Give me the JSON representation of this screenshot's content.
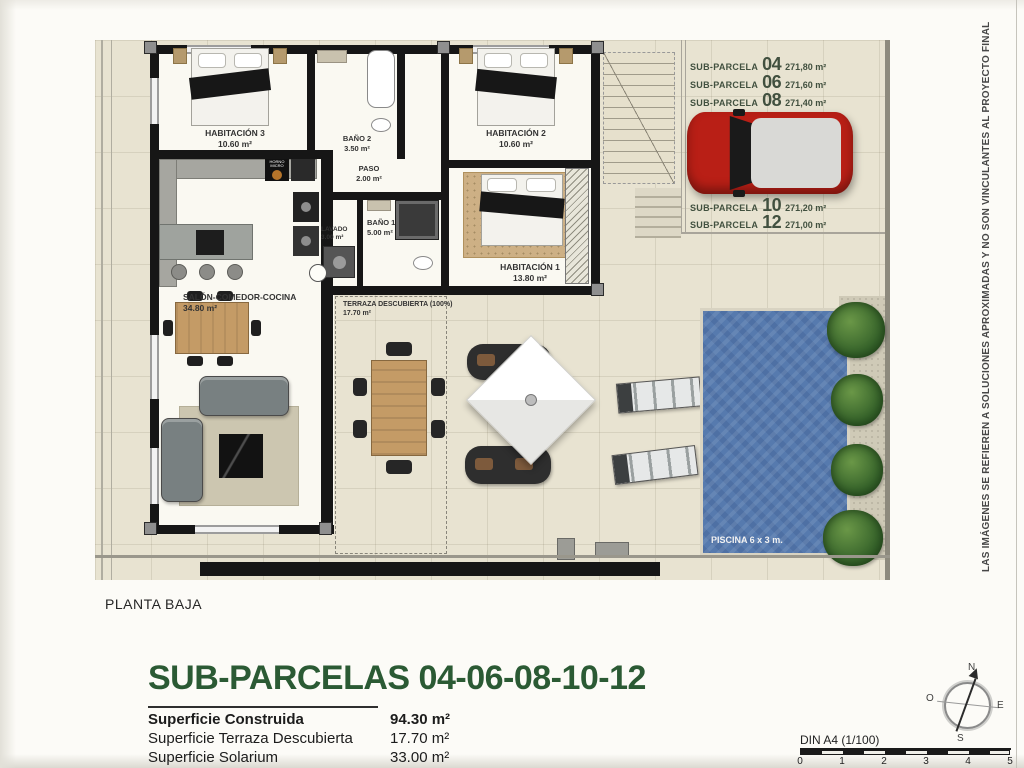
{
  "page": {
    "planta_label": "PLANTA BAJA",
    "title": "SUB-PARCELAS 04-06-08-10-12",
    "disclaimer": "LAS IMÁGENES SE REFIEREN A SOLUCIONES APROXIMADAS Y NO SON VINCULANTES AL PROYECTO FINAL"
  },
  "subparcelas": {
    "top": [
      {
        "label": "SUB-PARCELA",
        "number": "04",
        "area": "271,80 m²"
      },
      {
        "label": "SUB-PARCELA",
        "number": "06",
        "area": "271,60 m²"
      },
      {
        "label": "SUB-PARCELA",
        "number": "08",
        "area": "271,40 m²"
      }
    ],
    "bottom": [
      {
        "label": "SUB-PARCELA",
        "number": "10",
        "area": "271,20 m²"
      },
      {
        "label": "SUB-PARCELA",
        "number": "12",
        "area": "271,00 m²"
      }
    ]
  },
  "rooms": {
    "habitacion3": {
      "name": "HABITACIÓN 3",
      "area": "10.60 m²"
    },
    "bano2": {
      "name": "BAÑO 2",
      "area": "3.50 m²"
    },
    "habitacion2": {
      "name": "HABITACIÓN 2",
      "area": "10.60 m²"
    },
    "paso": {
      "name": "PASO",
      "area": "2.00 m²"
    },
    "lavado": {
      "name": "LAVADO",
      "area": "3.00 m²"
    },
    "bano1": {
      "name": "BAÑO 1",
      "area": "5.00 m²"
    },
    "habitacion1": {
      "name": "HABITACIÓN 1",
      "area": "13.80 m²"
    },
    "salon": {
      "name": "SALÓN-COMEDOR-COCINA",
      "area": "34.80 m²"
    },
    "terraza": {
      "name": "TERRAZA DESCUBIERTA (100%)",
      "area": "17.70 m²"
    }
  },
  "kitchen": {
    "appliance_label": "HORNO MICRO"
  },
  "piscina": {
    "label": "PISCINA 6 x 3 m."
  },
  "surfaces": [
    {
      "label": "Superficie Construida",
      "value": "94.30 m²"
    },
    {
      "label": "Superficie Terraza Descubierta",
      "value": "17.70 m²"
    },
    {
      "label": "Superficie Solarium",
      "value": "33.00 m²"
    }
  ],
  "scalebar": {
    "label": "DIN A4 (1/100)",
    "ticks": [
      "0",
      "1",
      "2",
      "3",
      "4",
      "5"
    ]
  },
  "compass": {
    "north": "N",
    "south": "S",
    "east": "E",
    "west": "O"
  },
  "colors": {
    "title_green": "#2b5a34",
    "subparcela_green": "#41503f",
    "pool_blue": "#567aae",
    "car_red": "#b91f16",
    "plan_beige": "#e8e3d1"
  }
}
